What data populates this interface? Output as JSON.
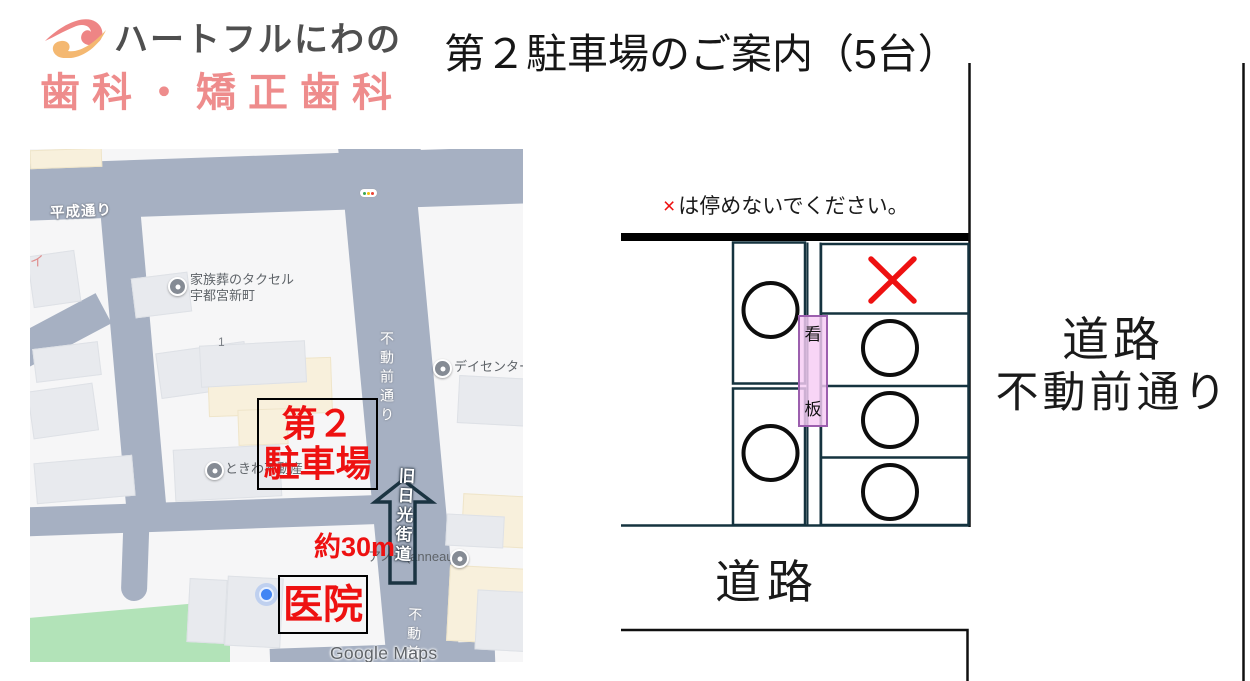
{
  "colors": {
    "accent_red": "#ee1111",
    "logo_pink": "#ee8c8c",
    "logo_gray": "#4f4f4f",
    "map_road": "#a6b0c2",
    "park_green": "#b2e3b8",
    "signboard_pink": "#f6ccf4",
    "signboard_border": "#9c5fae",
    "diagram_line": "#1b3a4a"
  },
  "logo": {
    "line1": "ハートフルにわの",
    "line2": "歯科・矯正歯科"
  },
  "title": "第２駐車場のご案内（5台）",
  "map": {
    "road_labels": {
      "heisei": "平成通り",
      "fudomae_vertical": "不動前通り",
      "kyu_nikko": "旧日光街道",
      "fudomae_bottom": "不動前"
    },
    "pois": [
      {
        "name": "家族葬のタクセル",
        "name2": "宇都宮新町"
      },
      {
        "name": "デイセンター"
      },
      {
        "name": "ときわ不動産"
      },
      {
        "name": "アノー(anneau)"
      }
    ],
    "block_number": "1",
    "edge_text": "イ",
    "annotations": {
      "parking_line1": "第２",
      "parking_line2": "駐車場",
      "distance": "約30m",
      "clinic": "医院"
    },
    "watermark": "Google Maps"
  },
  "diagram": {
    "note_mark": "×",
    "note_text": "は停めないでください。",
    "sign_top": "看",
    "sign_bottom": "板",
    "road_right_line1": "道路",
    "road_right_line2": "不動前通り",
    "road_bottom": "道路",
    "spots": {
      "left_column": [
        "circle",
        "circle"
      ],
      "right_column": [
        "x",
        "circle",
        "circle",
        "circle"
      ]
    }
  }
}
